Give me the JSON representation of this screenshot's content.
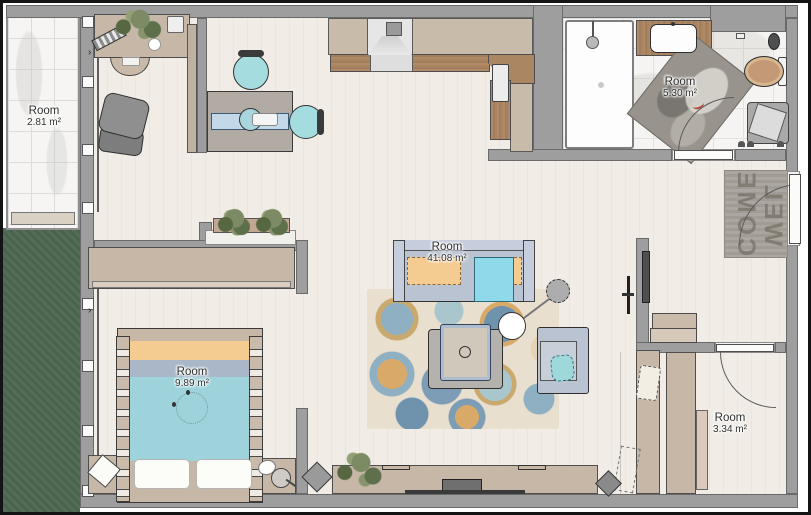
{
  "plan": {
    "rooms": {
      "balcony": {
        "label": "Room",
        "area": "2.81 m²"
      },
      "bathroom": {
        "label": "Room",
        "area": "5.30 m²"
      },
      "living": {
        "label": "Room",
        "area": "41.08 m²"
      },
      "bedroom": {
        "label": "Room",
        "area": "9.89 m²"
      },
      "closet": {
        "label": "Room",
        "area": "3.34 m²"
      }
    },
    "doormat": {
      "line1": "WEL",
      "line2": "COME"
    },
    "colors": {
      "wall": "#9e9e9e",
      "floor": "#f0ebe4",
      "grass": "#4e6852",
      "marble": "#f6f5f3",
      "counter_top": "#c9bbaa",
      "counter_wood": "#aa8663",
      "sofa": "#b9c3d2",
      "teal": "#9ed3dc",
      "orange": "#f4cc92"
    }
  }
}
